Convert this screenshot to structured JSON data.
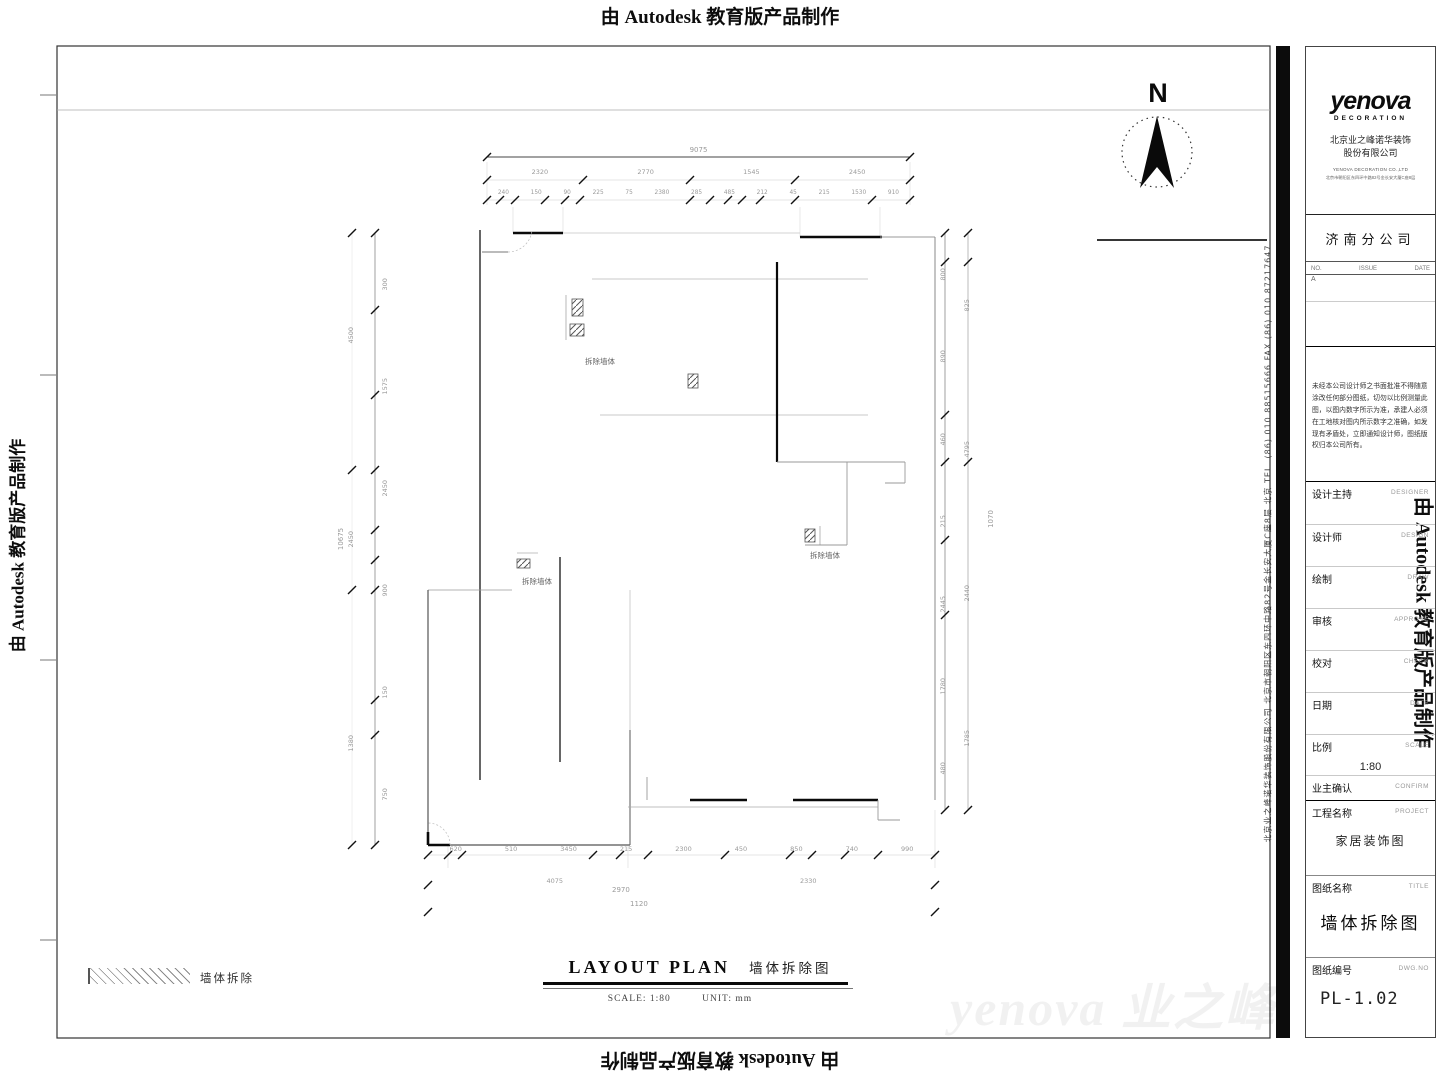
{
  "watermarks": {
    "autodesk": "由 Autodesk 教育版产品制作",
    "brand": "yenova 业之峰"
  },
  "north_label": "N",
  "side_text": "北京业之峰诺华装饰股份有限公司  北京市朝阳区东四环中路82号金长安大厦C座8层  北京  TEL. (86) 010 88515666   FAX (86) 010 87217647",
  "legend": {
    "label": "墙体拆除"
  },
  "plan_title": {
    "en": "LAYOUT PLAN",
    "zh": "墙体拆除图",
    "scale": "SCALE: 1:80",
    "unit": "UNIT: mm"
  },
  "plan": {
    "overall_top": "9075",
    "overall_left": "10675",
    "dims_top_row2": [
      "2320",
      "2770",
      "1545",
      "2450"
    ],
    "dims_top_row3": [
      "240",
      "150",
      "90",
      "225",
      "75",
      "2380",
      "285",
      "485",
      "212",
      "45",
      "215",
      "1530",
      "910"
    ],
    "dims_bottom_row1": [
      "620",
      "510",
      "3450",
      "215",
      "2300",
      "450",
      "850",
      "740",
      "990"
    ],
    "dims_bottom_row2": [
      "4075",
      "2330"
    ],
    "dims_bottom_row3": [
      "2970",
      "1120"
    ],
    "dims_left_outer": [
      "4500",
      "2450",
      "1380"
    ],
    "dims_left_inner": [
      "300",
      "1575",
      "2450",
      "900",
      "150",
      "750"
    ],
    "dims_right_inner": [
      "800",
      "890",
      "460",
      "215",
      "2445",
      "1780",
      "480"
    ],
    "dims_right_outer": [
      "825",
      "4795",
      "2440",
      "1785"
    ],
    "dims_right_extra": [
      "1070"
    ],
    "annotations": [
      "拆除墙体",
      "拆除墙体",
      "拆除墙体"
    ]
  },
  "titleblock": {
    "logo": "yenova",
    "logo_sub": "DECORATION",
    "company_cn": "北京业之峰诺华装饰",
    "company_cn2": "股份有限公司",
    "company_en": "YENOVA DECORATION CO.,LTD",
    "company_addr": "北京市朝阳区东四环中路82号金长安大厦C座8层",
    "branch": "济南分公司",
    "rev_no": "NO.",
    "rev_issue": "ISSUE",
    "rev_date": "DATE",
    "rev_mark": "A",
    "notice_lines": "未经本公司设计师之书面批准不得随意涂改任何部分图纸，切勿以比例测量此图，以图内数字所示为准，承建人必须在工地核对图内所示数字之准确，如发现有矛盾处，立即通知设计师，图纸版权归本公司所有。",
    "fields": [
      {
        "label": "设计主持",
        "en": "DESIGNER",
        "value": ""
      },
      {
        "label": "设计师",
        "en": "DESIGN",
        "value": ""
      },
      {
        "label": "绘制",
        "en": "DRAW",
        "value": ""
      },
      {
        "label": "审核",
        "en": "APPROVE",
        "value": ""
      },
      {
        "label": "校对",
        "en": "CHECK",
        "value": ""
      },
      {
        "label": "日期",
        "en": "DATE",
        "value": ""
      },
      {
        "label": "比例",
        "en": "SCALE",
        "value": "1:80"
      },
      {
        "label": "业主确认",
        "en": "CONFIRM",
        "value": ""
      }
    ],
    "project_label": "工程名称",
    "project_en": "PROJECT",
    "project_value": "家居装饰图",
    "sheet_label": "图纸名称",
    "sheet_en": "TITLE",
    "sheet_value": "墙体拆除图",
    "dwg_label": "图纸编号",
    "dwg_en": "DWG.NO",
    "dwg_value": "PL-1.02"
  }
}
